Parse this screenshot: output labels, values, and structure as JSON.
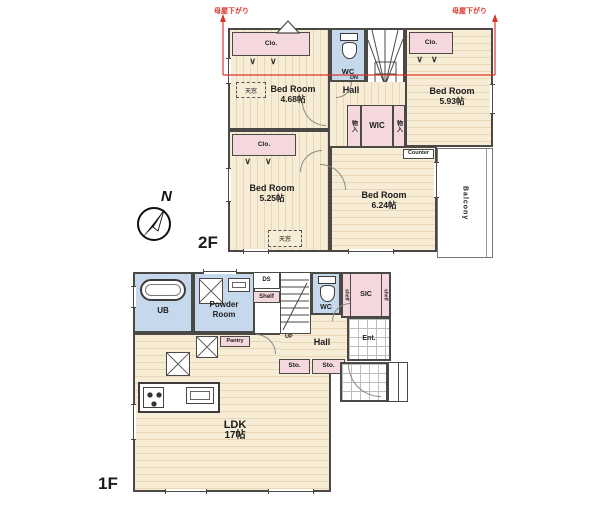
{
  "annotations": {
    "roof_left": "母屋下がり",
    "roof_right": "母屋下がり"
  },
  "compass": {
    "north": "N"
  },
  "floor2": {
    "label": "2F",
    "bedroom_nw": {
      "name": "Bed Room",
      "size": "4.68帖"
    },
    "bedroom_sw": {
      "name": "Bed Room",
      "size": "5.25帖"
    },
    "bedroom_ne": {
      "name": "Bed Room",
      "size": "5.93帖"
    },
    "bedroom_se": {
      "name": "Bed Room",
      "size": "6.24帖"
    },
    "hall": "Hall",
    "wc": "WC",
    "wic": "WIC",
    "storage": "物入",
    "closet": "Clo.",
    "skylight": "天窓",
    "counter": "Counter",
    "balcony": "Balcony",
    "down": "DN"
  },
  "floor1": {
    "label": "1F",
    "ldk": {
      "name": "LDK",
      "size": "17帖"
    },
    "bath": "UB",
    "powder": {
      "line1": "Powder",
      "line2": "Room"
    },
    "wc": "WC",
    "sic": "SIC",
    "shelf_vertical": "shelf",
    "shelf": "Shelf",
    "ds": "DS",
    "hall": "Hall",
    "entrance": "Ent.",
    "storage": "Sto.",
    "pantry": "Pantry",
    "up": "UP"
  },
  "colors": {
    "wall": "#4b4945",
    "red_annotation": "#d9352e",
    "closet_pink": "#f4d8de",
    "wet_area_blue": "#c6d9ec",
    "floor_cream": "#f7ecd6"
  }
}
